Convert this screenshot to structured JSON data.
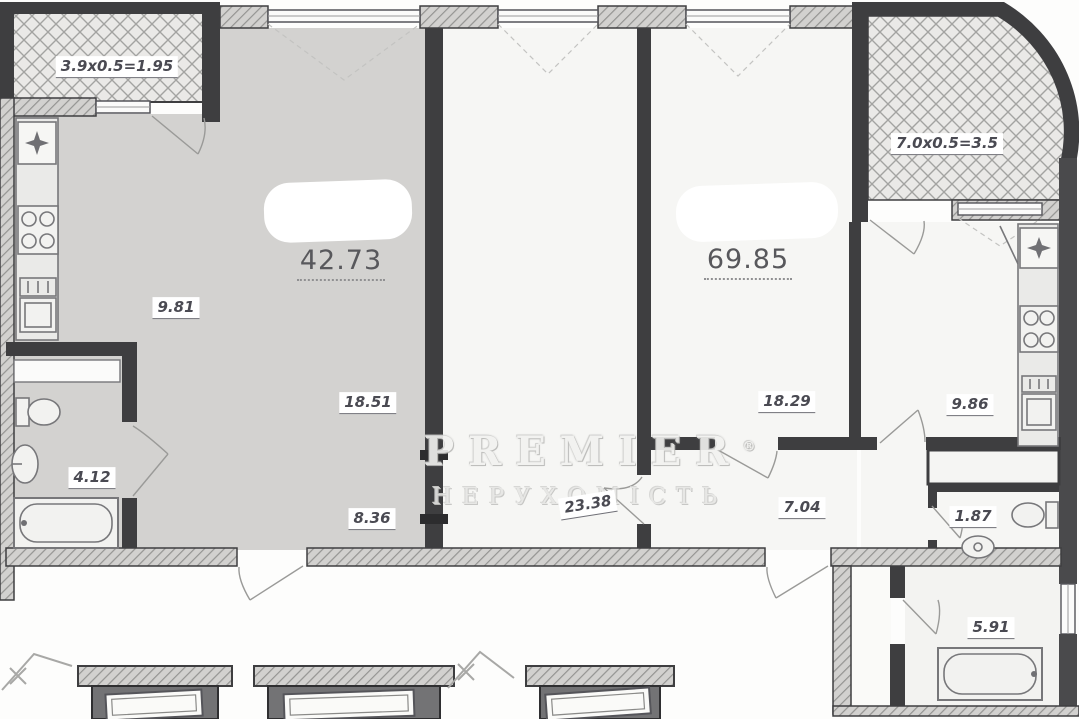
{
  "watermark": {
    "brand": "PREMIER",
    "reg": "®",
    "tagline": "НЕРУХОМІСТЬ"
  },
  "areas": {
    "balcony_left": "3.9x0.5=1.95",
    "apartment_left_total": "42.73",
    "kitchen_left": "9.81",
    "room_left": "18.51",
    "hall_left": "8.36",
    "bath_left": "4.12",
    "living_mid": "23.38",
    "apartment_right_total": "69.85",
    "bedroom_right": "18.29",
    "hall_right": "7.04",
    "kitchen_right": "9.86",
    "wc_right": "1.87",
    "bath_right": "5.91",
    "balcony_right": "7.0x0.5=3.5"
  },
  "colors": {
    "wall": "#3e3e40",
    "left_apartment_fill": "#d3d2d0",
    "room_fill": "#f6f6f4",
    "balcony_hatch_line": "#a3a3a1",
    "label_text": "#4a4a52",
    "elevator_shaft": "#737375"
  }
}
